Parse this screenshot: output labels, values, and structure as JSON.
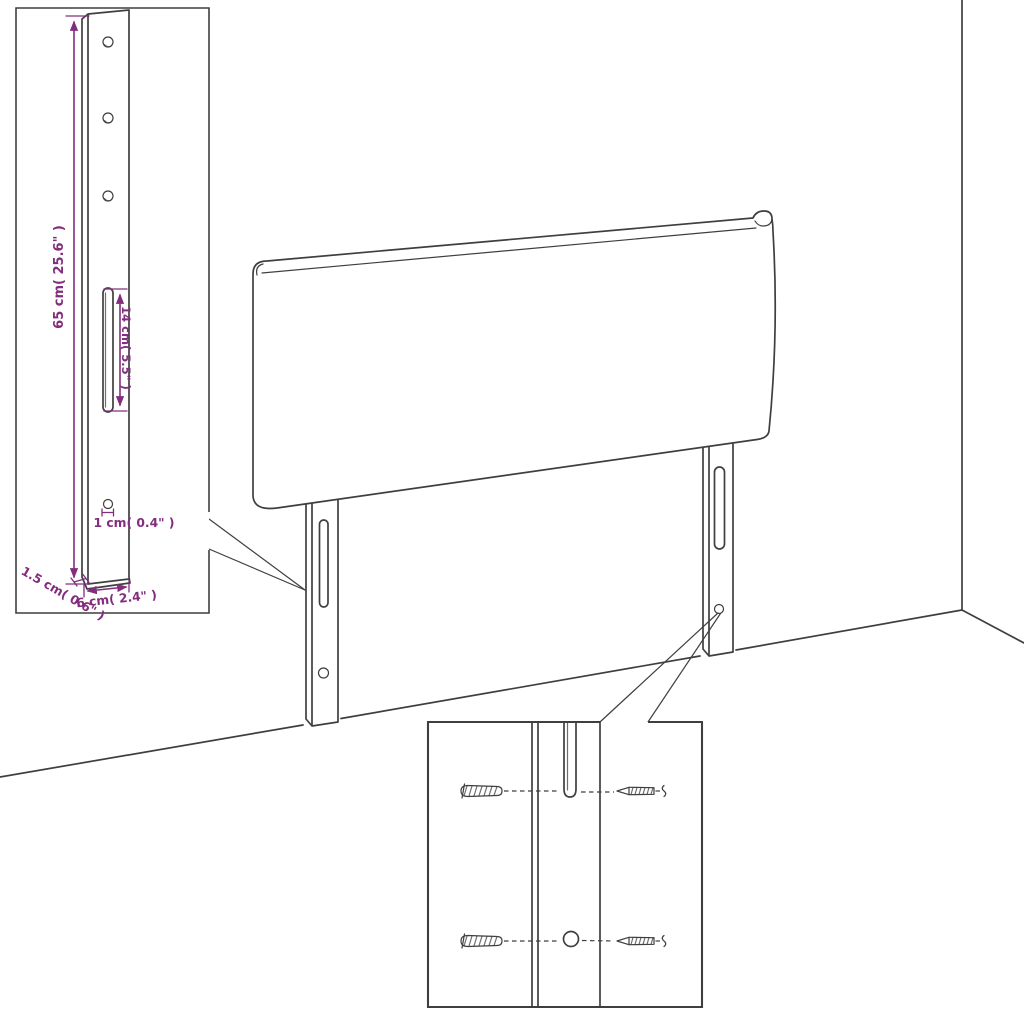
{
  "diagram": {
    "kind": "product-dimension-diagram",
    "subject": "headboard with two mounting legs shown in a room corner",
    "background_color": "#ffffff",
    "line_color": "#3f3f3f",
    "dimension_color": "#822d7d"
  },
  "labels": {
    "leg_height": "65 cm( 25.6\" )",
    "slot_length": "14 cm( 5.5\" )",
    "hole_diameter": "1 cm( 0.4\" )",
    "leg_depth": "1.5 cm( 0.6\" )",
    "leg_width": "6 cm( 2.4\" )"
  },
  "figures": {
    "main": "headboard-with-two-mounting-legs",
    "top_left_inset": "mounting-leg-dimension-detail",
    "bottom_inset": "wall-fixing-detail-screws-and-wall-plugs"
  }
}
